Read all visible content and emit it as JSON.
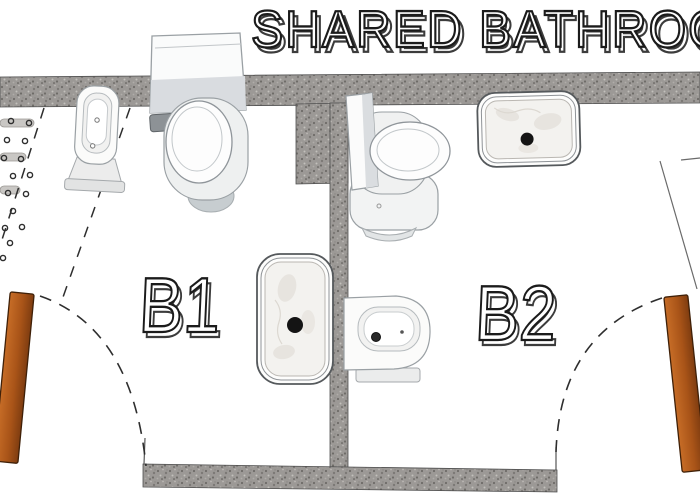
{
  "title": "SHARED BATHROOM",
  "rooms": [
    {
      "label": "B1"
    },
    {
      "label": "B2"
    }
  ],
  "fixtures": {
    "b1": [
      "toilet",
      "bidet",
      "marble-sink",
      "shower-floor-area"
    ],
    "b2": [
      "toilet",
      "marble-sink",
      "bidet"
    ]
  },
  "doors": [
    {
      "room": "B1",
      "position": "bottom-left",
      "swing": "dashed-arc"
    },
    {
      "room": "B2",
      "position": "bottom-right",
      "swing": "dashed-arc"
    }
  ],
  "colors": {
    "background": "#ffffff",
    "wall": "#9c9996",
    "wall_speckle_dark": "#6e6b68",
    "wall_speckle_light": "#bcb9b5",
    "door": "#b05a1c",
    "door_dark": "#7e3c10",
    "marble": "#f3f2ef",
    "drain": "#141414",
    "fixture_outline": "#9aa0a4",
    "label_outline": "#1b1b1b",
    "dash_line": "#2e2e2e"
  }
}
